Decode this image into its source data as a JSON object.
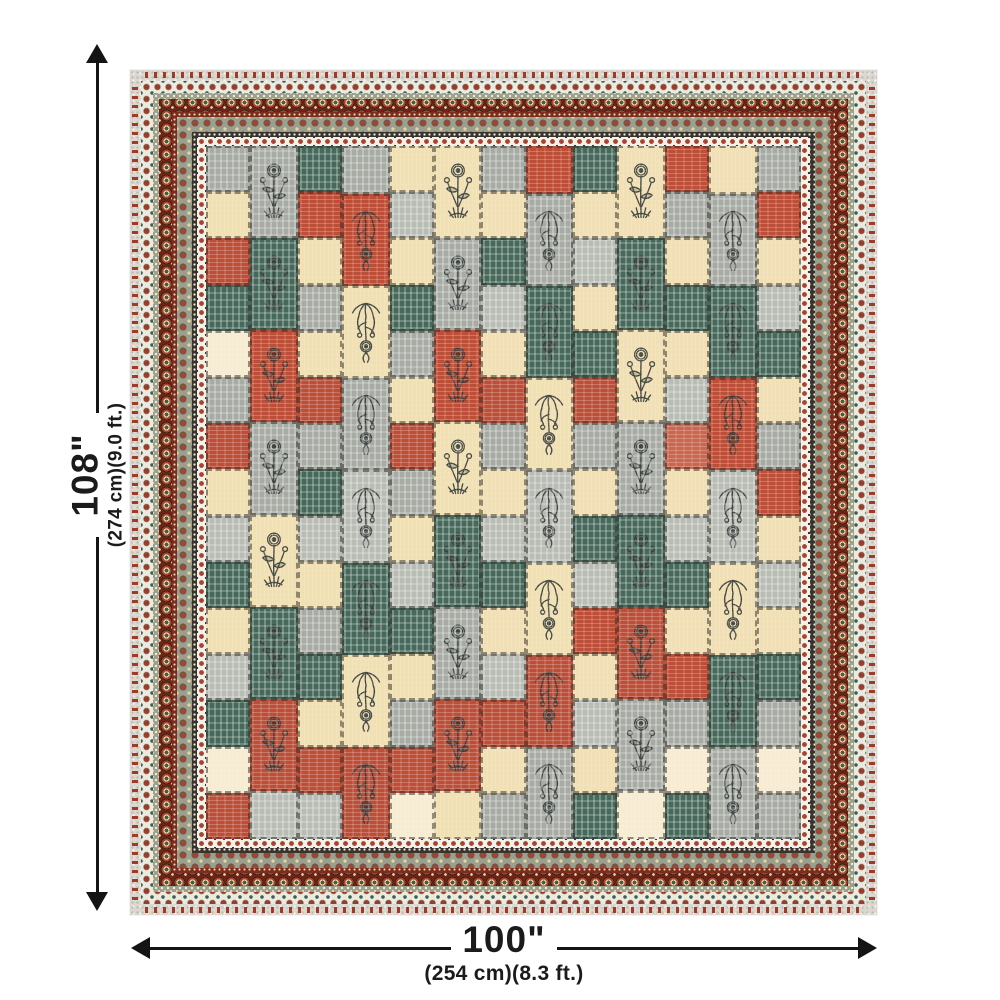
{
  "page": {
    "background": "#ffffff"
  },
  "height_dimension": {
    "label": "108\"",
    "detail": "(274 cm)(9.0 ft.)"
  },
  "width_dimension": {
    "label": "100\"",
    "detail": "(254 cm)(8.3 ft.)"
  },
  "quilt": {
    "palette": {
      "C": "#f1e0b4",
      "c": "#f7ecd2",
      "G": "#a7aba4",
      "g": "#b9bcb4",
      "T": "#47695b",
      "t": "#3b5d50",
      "R": "#bd4e38",
      "r": "#cb664f"
    },
    "border_colors": {
      "selvage": "#dad8d0",
      "tassel": "#a03a27",
      "maroon": "#6e2517",
      "maroon2": "#7c2d1c",
      "sage": "#9ba08e",
      "cream": "#e4d4a2",
      "teal": "#3f5f52",
      "dark": "#39332d",
      "white": "#f3f1ea",
      "red": "#a8432e"
    },
    "rows": 15,
    "columns": [
      {
        "type": "plain",
        "cells": "GCRTcGRCgTCgTcR"
      },
      {
        "type": "up",
        "doubles": "GTRGCTR",
        "tail": "g"
      },
      {
        "type": "plain",
        "cells": "TRCGCRGTgCGTCRg"
      },
      {
        "type": "hang",
        "head": "G",
        "doubles": "RCGgTCR"
      },
      {
        "type": "plain",
        "cells": "CgCTGCRGCgTCGRc"
      },
      {
        "type": "up",
        "doubles": "CGRCTGR",
        "tail": "C"
      },
      {
        "type": "plain",
        "cells": "GCTgCRGCgTCgRCG"
      },
      {
        "type": "hang",
        "head": "R",
        "doubles": "GTCgCRG"
      },
      {
        "type": "plain",
        "cells": "TCgCTRGCTgRCgCT"
      },
      {
        "type": "up",
        "doubles": "CTCGTRG",
        "tail": "c"
      },
      {
        "type": "plain",
        "cells": "RGCTCgrCgTCRGcT"
      },
      {
        "type": "hang",
        "head": "C",
        "doubles": "GTRgCTG"
      },
      {
        "type": "plain",
        "cells": "GRCgTCGRCgCTGcG"
      }
    ]
  }
}
